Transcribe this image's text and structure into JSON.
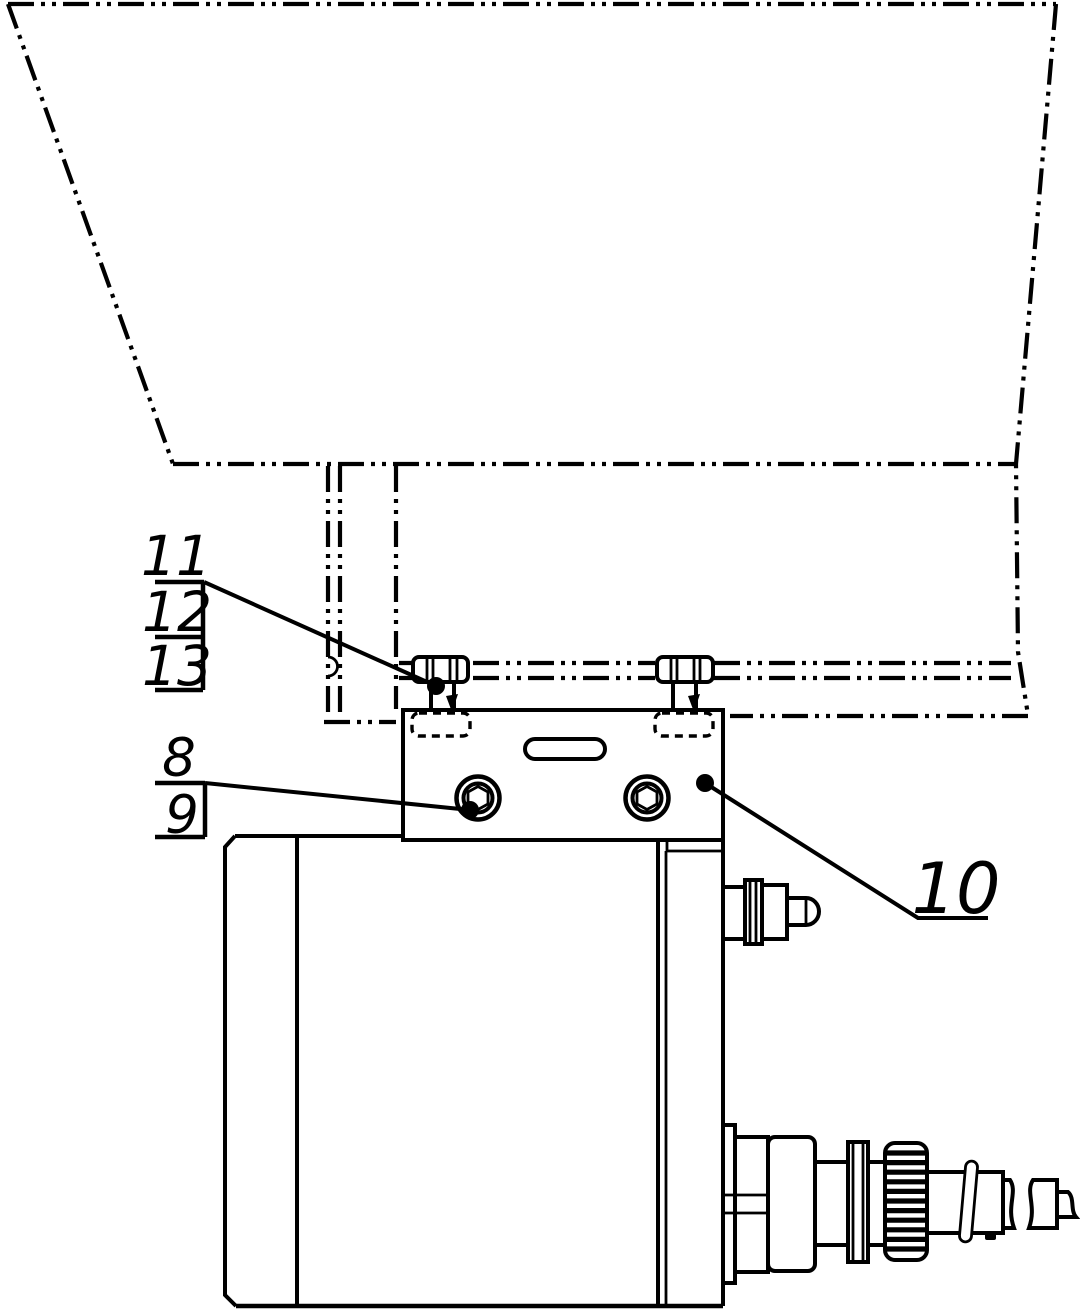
{
  "labels": {
    "l8": "8",
    "l9": "9",
    "l10": "10",
    "l11": "11",
    "l12": "12",
    "l13": "13"
  },
  "colors": {
    "line": "#000000",
    "background": "#ffffff"
  }
}
